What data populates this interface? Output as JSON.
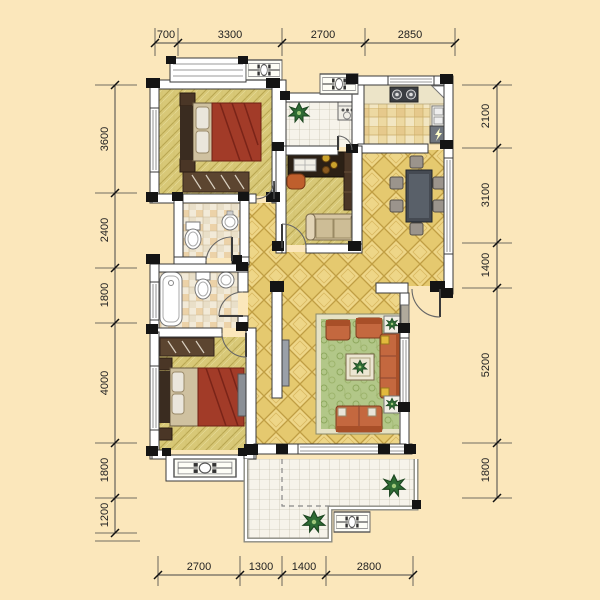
{
  "plan": {
    "kind": "apartment-floor-plan",
    "rooms_text_labels": "none-visible"
  },
  "dims": {
    "top": [
      "700",
      "3300",
      "2700",
      "2850"
    ],
    "left": [
      "3600",
      "2400",
      "1800",
      "4000",
      "1800",
      "1200"
    ],
    "right": [
      "2100",
      "3100",
      "1400",
      "5200",
      "1800"
    ],
    "bottom": [
      "2700",
      "1300",
      "1400",
      "2800"
    ]
  },
  "colors": {
    "background": "#fbe7bb",
    "wall_fill": "#ffffff",
    "wall_stroke": "#3a3a3a",
    "column": "#141414",
    "floor_wood": "#d8c877",
    "floor_gold_tile": "#e5c96f",
    "floor_kitchen_tile": "#edd9a2",
    "floor_white_tile": "#f6f3ea",
    "floor_bath_tile": "#f2ead8",
    "sofa_orange": "#c4683f",
    "bed_blanket_red": "#a23b28",
    "rug_green": "#b2c788",
    "dimension_text": "#222222"
  },
  "icons": {
    "plant-icon": "spiky-star-shape",
    "planter-box-icon": "rect-with-circle-pattern",
    "lightning-icon": "zigzag-bolt",
    "stove-icon": "two-burner-circles",
    "sink-icon": "double-basin",
    "toilet-icon": "tank-and-bowl",
    "bathtub-icon": "rounded-tub"
  }
}
